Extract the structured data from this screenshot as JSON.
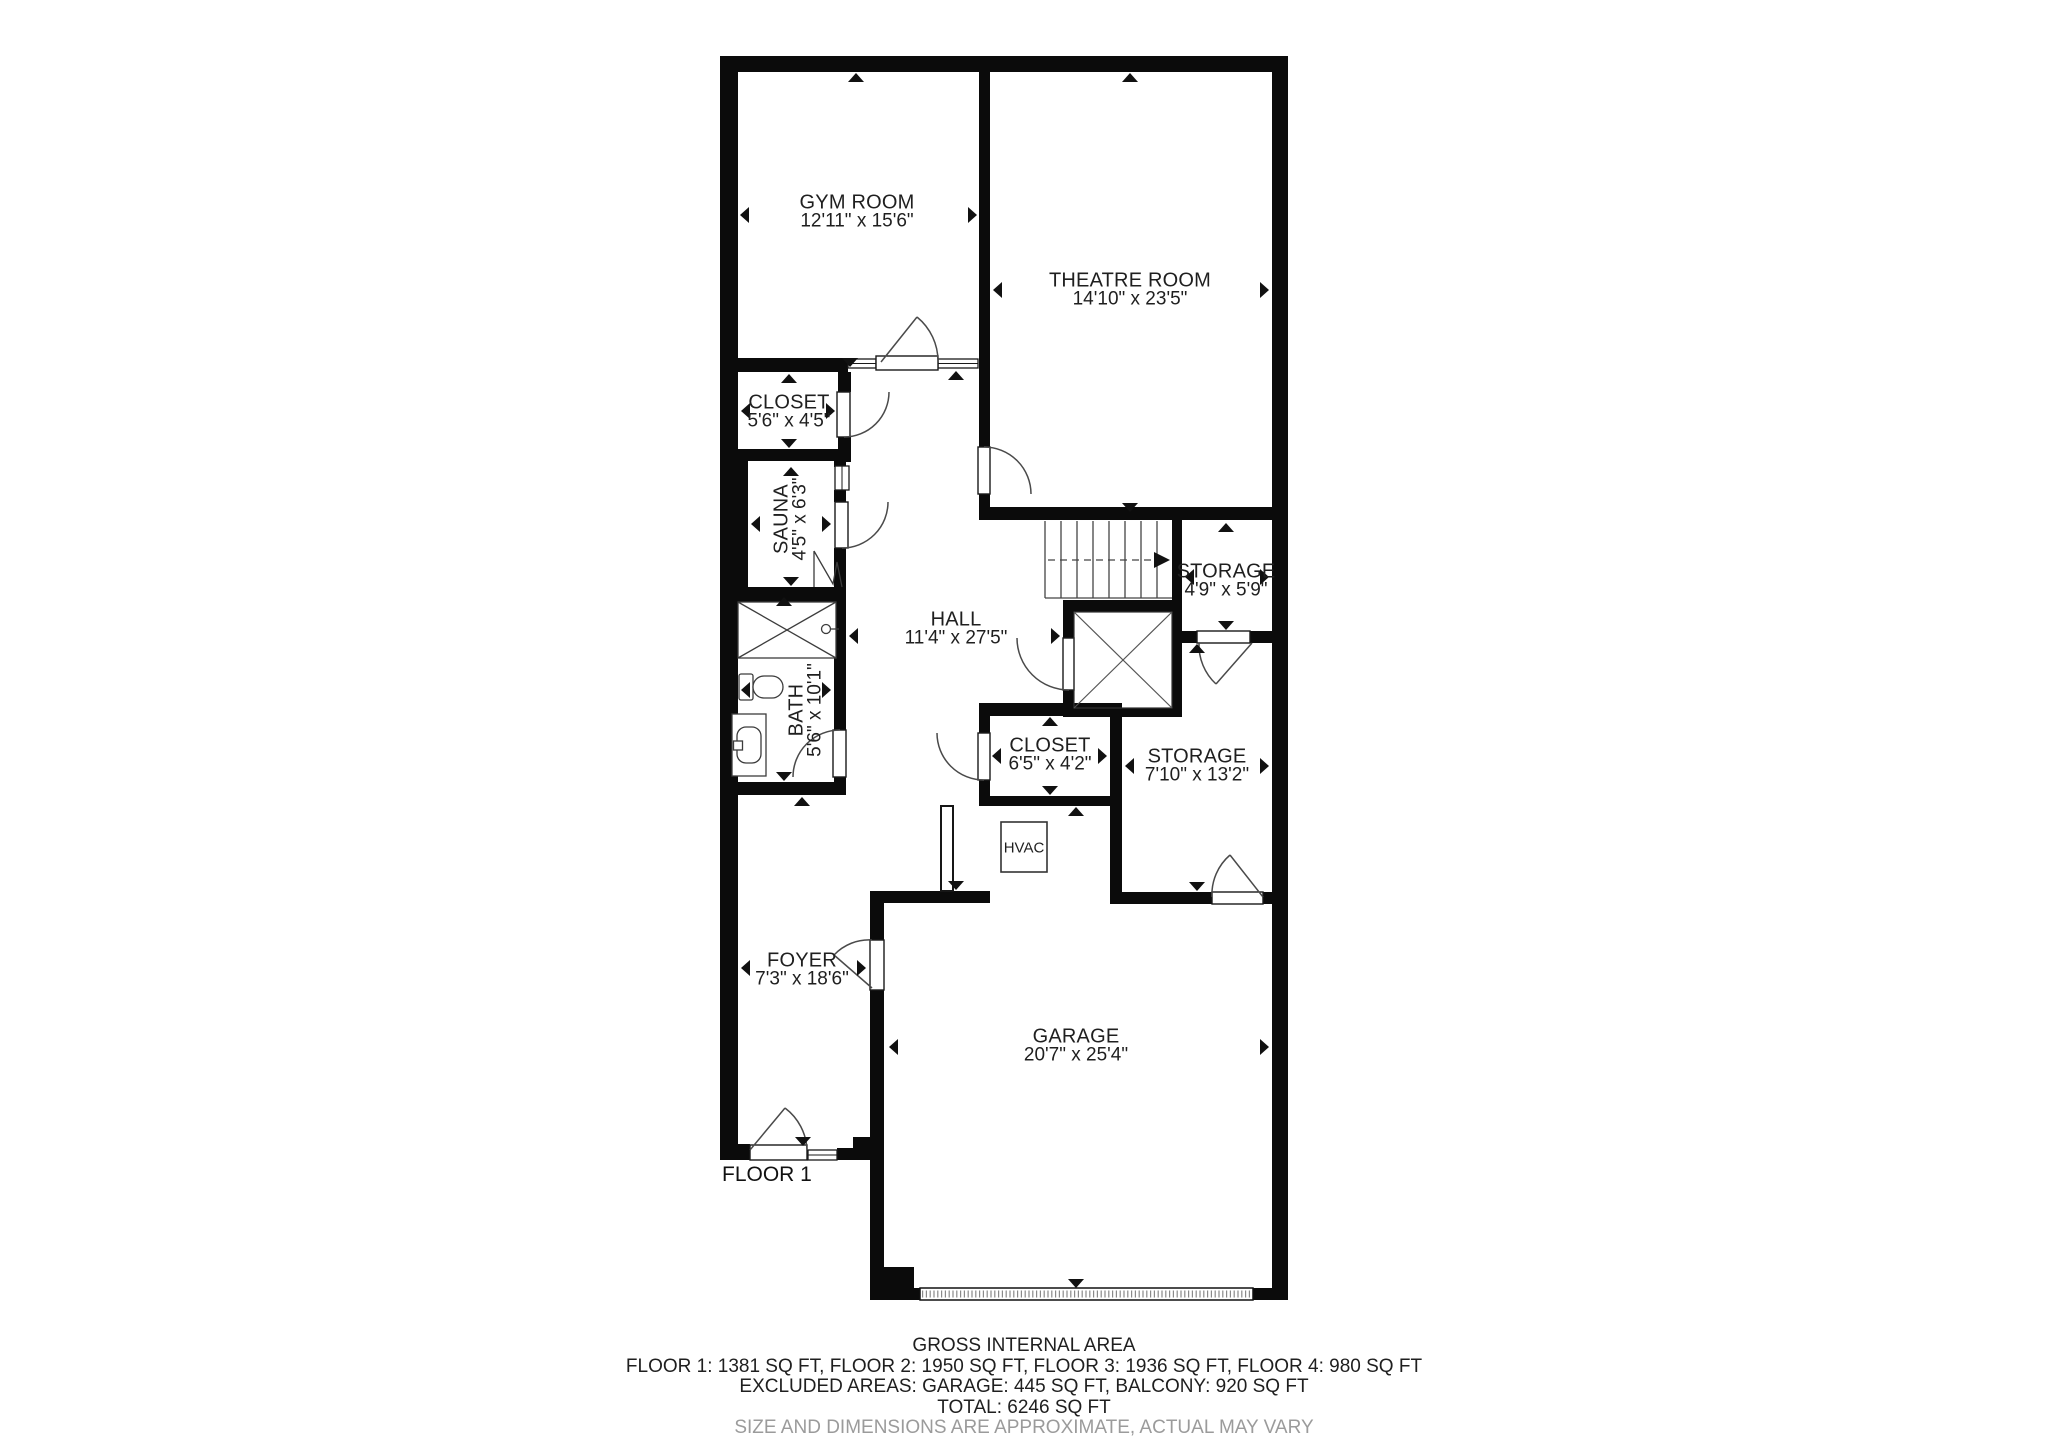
{
  "plan": {
    "floor_label": "FLOOR 1",
    "rooms": [
      {
        "name": "GYM ROOM",
        "dims": "12'11\" x 15'6\""
      },
      {
        "name": "THEATRE ROOM",
        "dims": "14'10\" x 23'5\""
      },
      {
        "name": "CLOSET",
        "dims": "5'6\" x 4'5\""
      },
      {
        "name": "SAUNA",
        "dims": "4'5\" x 6'3\""
      },
      {
        "name": "HALL",
        "dims": "11'4\" x 27'5\""
      },
      {
        "name": "STORAGE",
        "dims": "4'9\" x 5'9\""
      },
      {
        "name": "BATH",
        "dims": "5'6\" x 10'1\""
      },
      {
        "name": "CLOSET",
        "dims": "6'5\" x 4'2\""
      },
      {
        "name": "STORAGE",
        "dims": "7'10\" x 13'2\""
      },
      {
        "name": "FOYER",
        "dims": "7'3\" x 18'6\""
      },
      {
        "name": "GARAGE",
        "dims": "20'7\" x 25'4\""
      },
      {
        "name": "HVAC",
        "dims": ""
      }
    ],
    "footer": {
      "title": "GROSS INTERNAL AREA",
      "floors": "FLOOR 1: 1381 SQ FT, FLOOR 2: 1950 SQ FT, FLOOR 3: 1936 SQ FT, FLOOR 4: 980 SQ FT",
      "excluded": "EXCLUDED AREAS: GARAGE: 445 SQ FT, BALCONY: 920 SQ FT",
      "total": "TOTAL: 6246 SQ FT",
      "disclaimer": "SIZE AND DIMENSIONS ARE APPROXIMATE, ACTUAL MAY VARY"
    },
    "colors": {
      "wall": "#0b0b0b",
      "line": "#3c3c3c",
      "text": "#1f1f1f",
      "muted": "#9b9b9b",
      "background": "#ffffff"
    }
  }
}
